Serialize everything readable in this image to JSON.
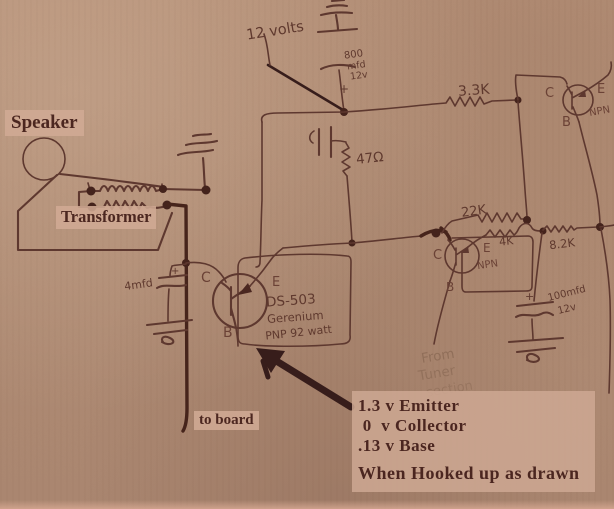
{
  "labels": {
    "speaker": "Speaker",
    "transformer": "Transformer",
    "to_board": "to board"
  },
  "annotation": {
    "line1": "1.3 v Emitter",
    "line2": " 0  v Collector",
    "line3": ".13 v Base",
    "line4": "When Hooked up as drawn"
  },
  "handwritten": {
    "supply_voltage": "12 volts",
    "cap_800_l1": "800",
    "cap_800_l2": "mfd",
    "cap_800_l3": "12v",
    "r_33k": "3.3K",
    "r_47": "47Ω",
    "r_22k": "22K",
    "r_4k": "4K",
    "r_82k": "8.2K",
    "cap_100_l1": "100mfd",
    "cap_100_l2": "12v",
    "cap_4": "4mfd",
    "q1_name": "DS-503",
    "q1_material": "Gerenium",
    "q1_rating": "PNP 92 watt",
    "tuner_l1": "From",
    "tuner_l2": "Tuner",
    "tuner_l3": "section",
    "npn": "NPN",
    "terminal_c": "C",
    "terminal_e": "E",
    "terminal_b": "B",
    "plus": "+"
  },
  "colors": {
    "paper": "#b08c74",
    "ink": "#5e382f",
    "heavy_ink": "#46241b",
    "marker_dark": "#371d1b",
    "typed_text": "#4b2620",
    "label_box": "#d0aa94",
    "faded_ink": "#8b6a55"
  }
}
